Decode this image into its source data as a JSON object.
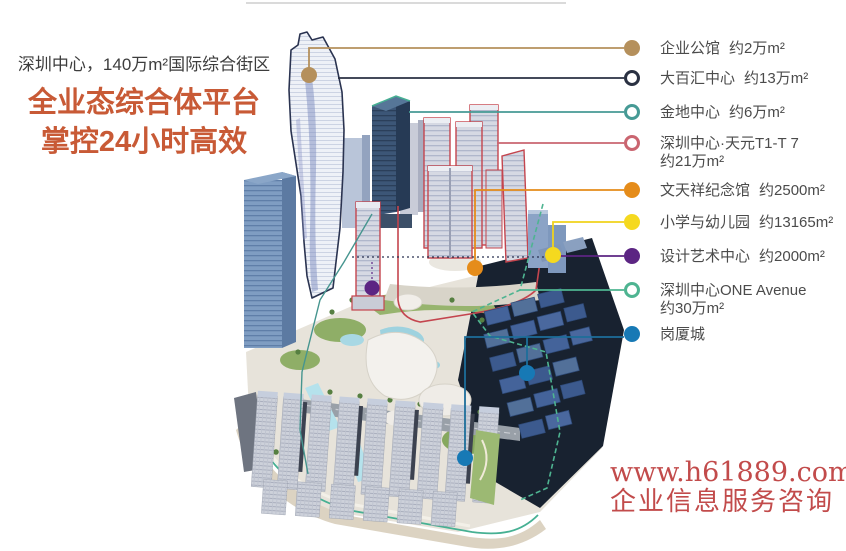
{
  "header": {
    "subtitle": "深圳中心，140万m²国际综合街区",
    "headline_line1": "全业态综合体平台",
    "headline_line2": "掌控24小时高效"
  },
  "legend": {
    "items": [
      {
        "label": "企业公馆",
        "area": "约2万m²",
        "marker": "filled",
        "color": "#b5905c",
        "wrap": false
      },
      {
        "label": "大百汇中心",
        "area": "约13万m²",
        "marker": "hollow",
        "color": "#2a3142",
        "wrap": false
      },
      {
        "label": "金地中心",
        "area": "约6万m²",
        "marker": "hollow",
        "color": "#469a95",
        "wrap": false
      },
      {
        "label": "深圳中心·天元T1-T 7",
        "area": "约21万m²",
        "marker": "hollow",
        "color": "#ca6570",
        "wrap": true
      },
      {
        "label": "文天祥纪念馆",
        "area": "约2500m²",
        "marker": "filled",
        "color": "#e58c1a",
        "wrap": false
      },
      {
        "label": "小学与幼儿园",
        "area": "约13165m²",
        "marker": "filled",
        "color": "#f5d91f",
        "wrap": false
      },
      {
        "label": "设计艺术中心",
        "area": "约2000m²",
        "marker": "filled",
        "color": "#5c2583",
        "wrap": false
      },
      {
        "label": "深圳中心ONE Avenue",
        "area": "约30万m²",
        "marker": "hollow",
        "color": "#4eb491",
        "wrap": true
      },
      {
        "label": "岗厦城",
        "area": "",
        "marker": "filled",
        "color": "#1779b5",
        "wrap": false
      }
    ]
  },
  "watermark": {
    "url": "www.h61889.com",
    "caption": "企业信息服务咨询",
    "color": "#c24b4b"
  }
}
